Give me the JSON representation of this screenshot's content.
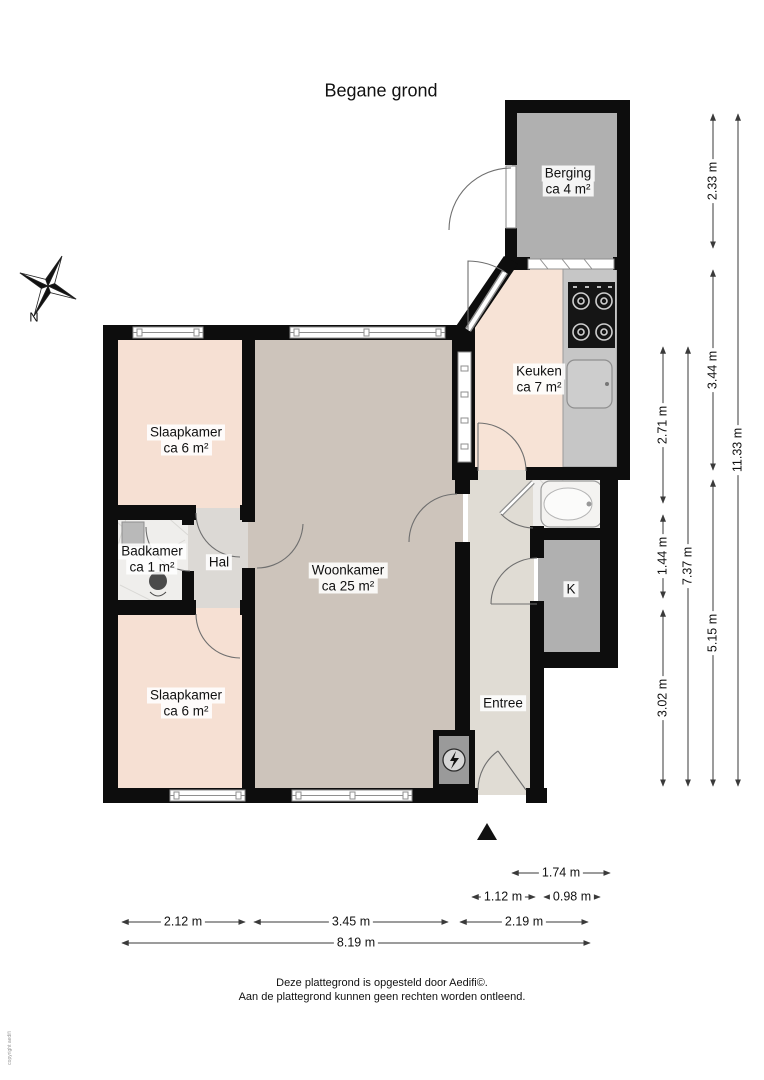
{
  "title": "Begane grond",
  "compass": {
    "label": "N"
  },
  "rooms": {
    "berging": {
      "name": "Berging",
      "area": "ca 4 m²"
    },
    "keuken": {
      "name": "Keuken",
      "area": "ca 7 m²"
    },
    "slaapkamer_boven": {
      "name": "Slaapkamer",
      "area": "ca 6 m²"
    },
    "badkamer": {
      "name": "Badkamer",
      "area": "ca 1 m²"
    },
    "hal": {
      "name": "Hal"
    },
    "woonkamer": {
      "name": "Woonkamer",
      "area": "ca 25 m²"
    },
    "slaapkamer_onder": {
      "name": "Slaapkamer",
      "area": "ca 6 m²"
    },
    "entree": {
      "name": "Entree"
    },
    "kast": {
      "name": "K"
    }
  },
  "dimensions": {
    "vertical": {
      "v_2_33": "2.33 m",
      "v_3_44": "3.44 m",
      "v_5_15": "5.15 m",
      "v_2_71": "2.71 m",
      "v_1_44": "1.44 m",
      "v_3_02": "3.02 m",
      "v_7_37": "7.37 m",
      "v_11_33": "11.33 m"
    },
    "horizontal": {
      "h_1_74": "1.74 m",
      "h_1_12": "1.12 m",
      "h_0_98": "0.98 m",
      "h_2_12": "2.12 m",
      "h_3_45": "3.45 m",
      "h_2_19": "2.19 m",
      "h_8_19": "8.19 m"
    }
  },
  "footer": {
    "line1": "Deze plattegrond is opgesteld door Aedifi©.",
    "line2": "Aan de plattegrond kunnen geen rechten worden ontleend."
  },
  "copyright_note": "copyright aedifi",
  "colors": {
    "wall": "#0d0d0d",
    "bedroom_floor": "#f6e0d3",
    "kitchen_floor": "#f7e3d6",
    "living_floor": "#cdc4bb",
    "hall_floor": "#dcd9d5",
    "entree_floor": "#e0dcd4",
    "storage_floor": "#b0b0b0",
    "closet_floor": "#b0b0b0",
    "bath_floor": "#efeeec",
    "counter": "#c6c6c6",
    "meter_floor": "#9a9a9a"
  }
}
